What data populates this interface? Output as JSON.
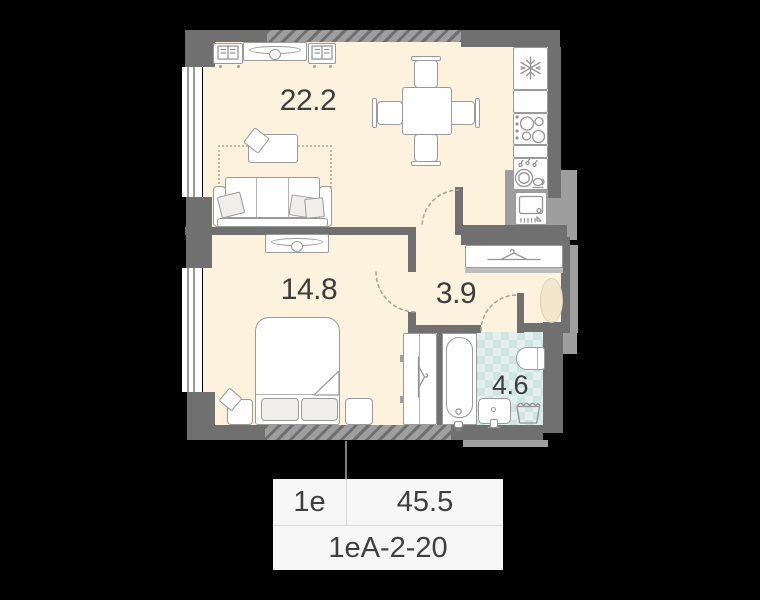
{
  "rooms": {
    "living": {
      "name": "living-kitchen",
      "area": "22.2"
    },
    "bedroom": {
      "name": "bedroom",
      "area": "14.8"
    },
    "hallway": {
      "name": "hallway",
      "area": "3.9"
    },
    "bathroom": {
      "name": "bathroom",
      "area": "4.6"
    }
  },
  "card": {
    "unit_type": "1е",
    "total_area": "45.5",
    "unit_code": "1еА-2-20"
  },
  "icons": {
    "fridge": "snowflake-icon",
    "wardrobe": "hanger-icon",
    "closet": "hanger-icon",
    "bookshelves": "open-book-icon",
    "stove": "burners-icon",
    "kitchen_sink": "dishes-icon",
    "oven": "oven-icon",
    "laundry": "basket-icon"
  },
  "colors": {
    "background": "#000000",
    "floor": "#fcf2de",
    "wall_dark": "#707070",
    "wall_light": "#9e9e9e",
    "tile_base": "#e4f0ee",
    "tile_check": "#cfe5e2",
    "rug_fill": "#f2e6cd",
    "card_bg": "#f6f6f6",
    "text": "#3d3d3d"
  }
}
